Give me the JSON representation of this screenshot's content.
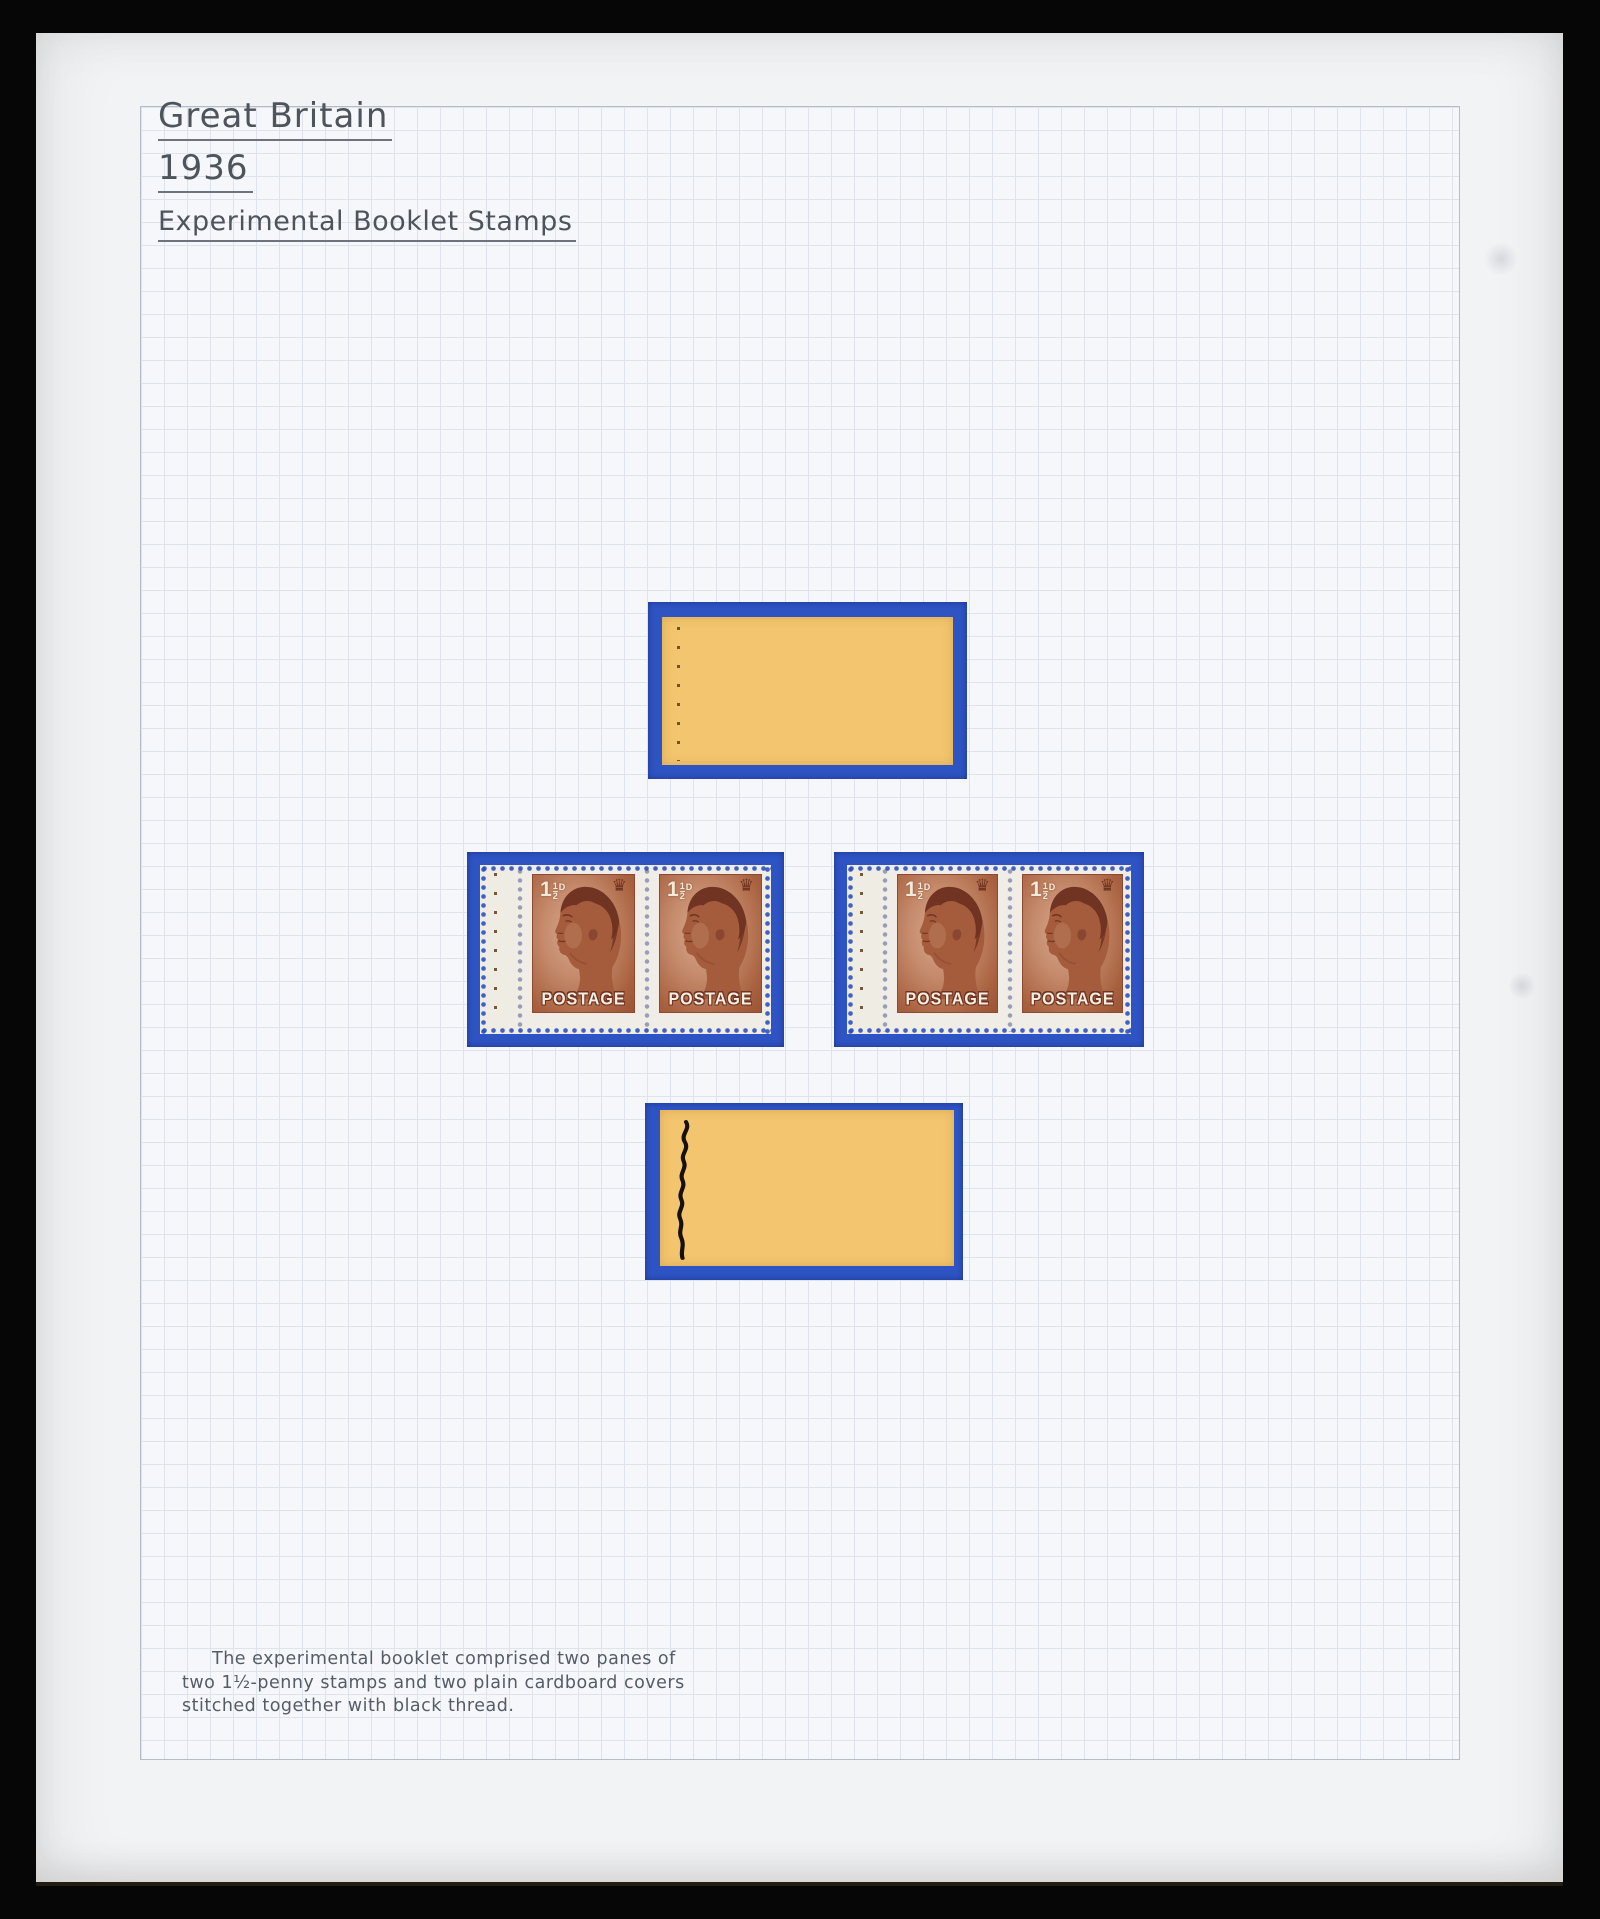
{
  "album_page": {
    "country": "Great Britain",
    "year": "1936",
    "subtitle": "Experimental Booklet Stamps",
    "caption": {
      "line1": "The experimental booklet comprised two panes of",
      "line2": "two 1½-penny stamps and two plain cardboard covers",
      "line3": "stitched together with black thread."
    }
  },
  "stamp": {
    "value_whole": "1",
    "value_frac_num": "1",
    "value_frac_den": "2",
    "value_letter": "D",
    "crown_glyph": "♛",
    "postage_label": "POSTAGE"
  },
  "colors": {
    "mount_blue": "#2e54c4",
    "cover_yellow": "#f2c56e",
    "stamp_red_brown": "#a85d3e",
    "paper": "#f2f3f5",
    "grid_line": "#dfe3eb",
    "ink": "#4e545c"
  }
}
